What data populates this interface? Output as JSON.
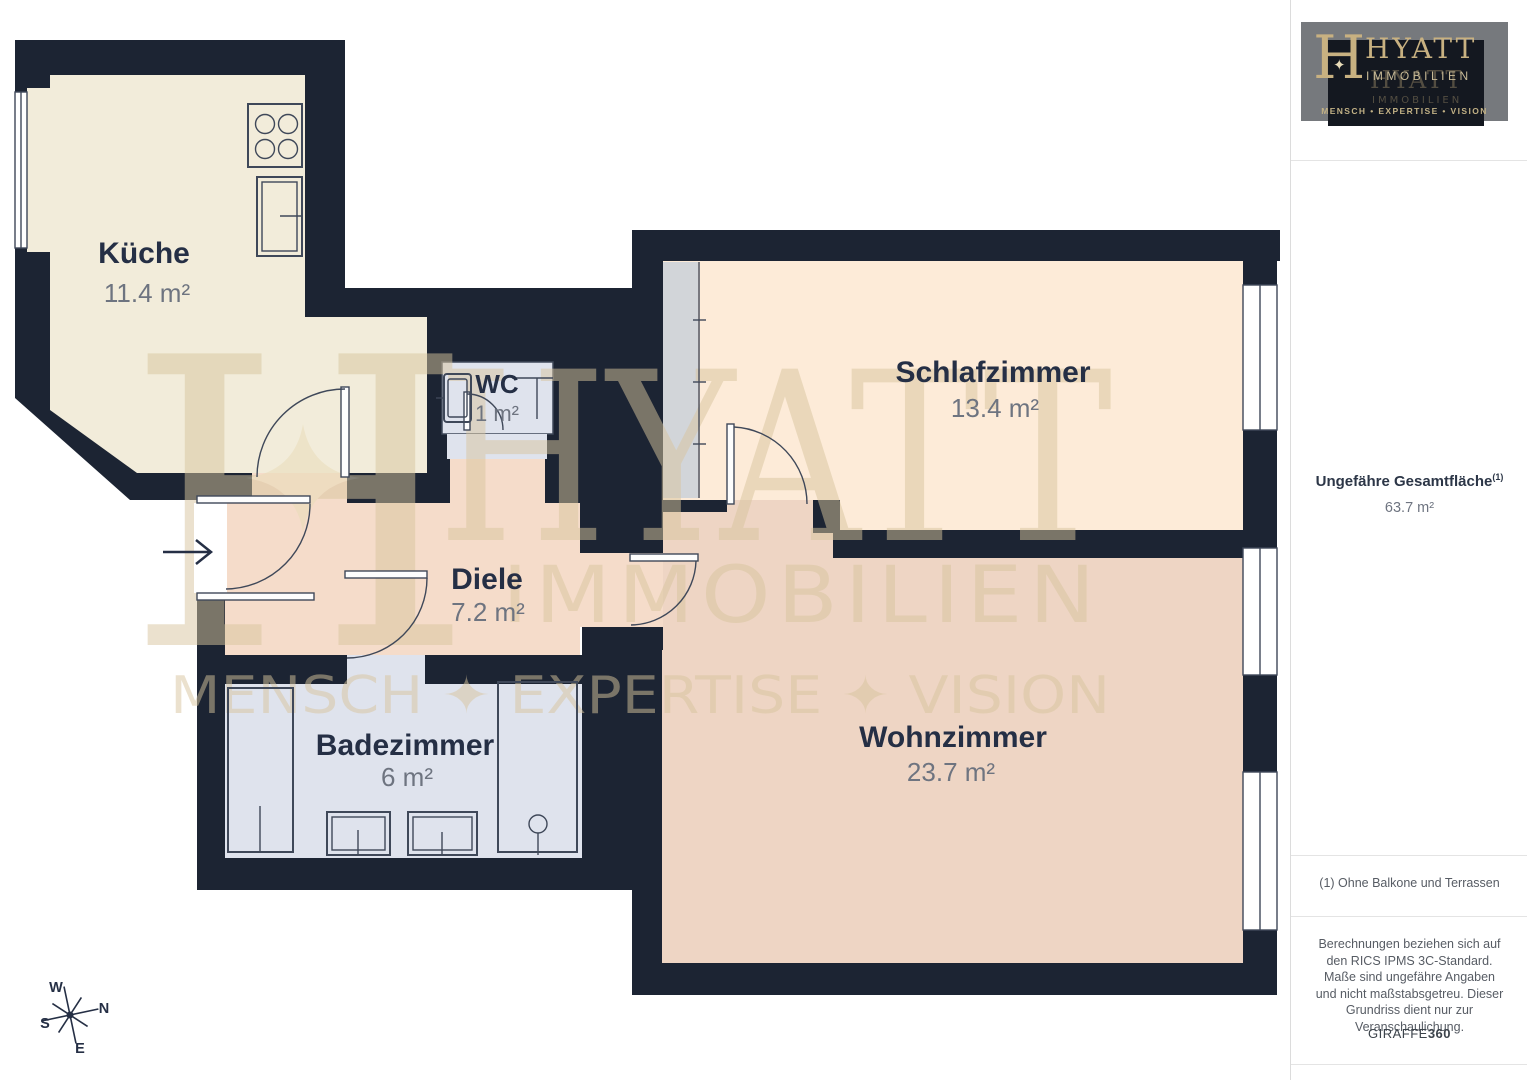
{
  "branding": {
    "logo": {
      "monogram": "H",
      "sparkle": "✦",
      "name": "HYATT",
      "division": "IMMOBILIEN",
      "tagline": "MENSCH • EXPERTISE • VISION"
    },
    "watermark": {
      "monogram": "H",
      "name": "HYATT",
      "division": "IMMOBILIEN",
      "tagline": "MENSCH ✦ EXPERTISE ✦ VISION"
    }
  },
  "floorplan": {
    "rooms": [
      {
        "id": "kueche",
        "name": "Küche",
        "area": "11.4 m²"
      },
      {
        "id": "wc",
        "name": "WC",
        "area": "1 m²"
      },
      {
        "id": "schlafzimmer",
        "name": "Schlafzimmer",
        "area": "13.4 m²"
      },
      {
        "id": "diele",
        "name": "Diele",
        "area": "7.2 m²"
      },
      {
        "id": "badezimmer",
        "name": "Badezimmer",
        "area": "6 m²"
      },
      {
        "id": "wohnzimmer",
        "name": "Wohnzimmer",
        "area": "23.7 m²"
      }
    ],
    "compass": {
      "north": "N",
      "east": "E",
      "south": "S",
      "west": "W"
    }
  },
  "sidebar": {
    "total_area_label": "Ungefähre Gesamtfläche",
    "total_area_footnote_marker": "(1)",
    "total_area_value": "63.7 m²",
    "footnote": "(1) Ohne Balkone und Terrassen",
    "disclaimer": "Berechnungen beziehen sich auf den RICS IPMS 3C-Standard. Maße sind ungefähre Angaben und nicht maßstabsgetreu. Dieser Grundriss dient nur zur Veranschaulichung.",
    "credit": {
      "brand": "GIRAFFE",
      "suffix": "360"
    }
  },
  "colors": {
    "wall": "#1c2433",
    "kueche": "#f2ecda",
    "schlafzimmer": "#fdebd8",
    "diele": "#f5dcca",
    "wohnzimmer": "#eed5c4",
    "bad": "#dfe3ed",
    "wardrobe": "#d2d5d9",
    "fixture": "#3f4859",
    "gold": "#d8c59e",
    "goldBright": "#e9dcb8",
    "labelDark": "#252f45",
    "labelGray": "#6e7480",
    "panelGray": "#76797d",
    "logoBg": "#141820",
    "logoGold": "#c8b181",
    "divider": "#e4e4e4",
    "textDark": "#2c3647",
    "textGray": "#575c64"
  }
}
